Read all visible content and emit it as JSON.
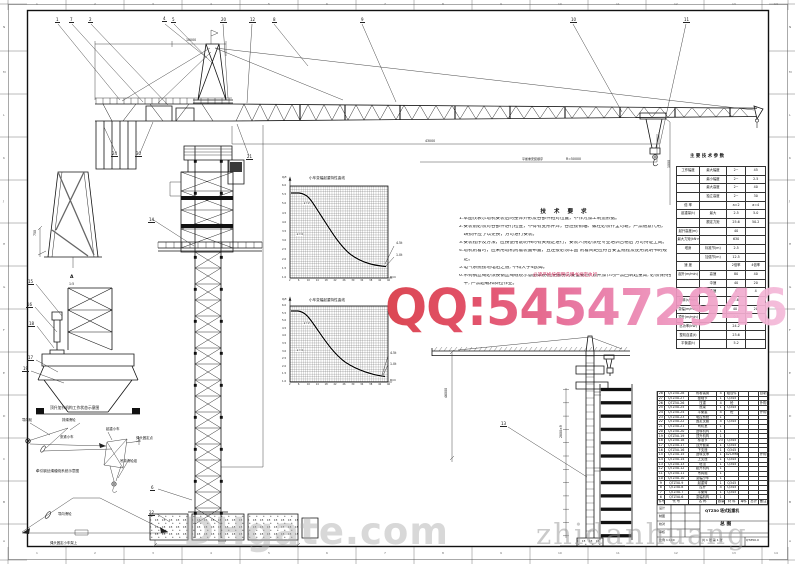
{
  "watermarks": {
    "qq": "QQ:545472946",
    "dhgate": "DHgate.com",
    "seller": "zhidanhuang"
  },
  "notes": {
    "title": "技 术 要 求",
    "lines": [
      "1.本图仅表示塔机安装后的整体外形及各部件相对位置，不作为加工制造依据。",
      "2.安装前必须对各部件进行检查，不得有变形开焊，各连接销轴、螺栓必须齐全可靠，严禁随意代用，",
      "　缺损件应予以更换，方可进行安装。",
      "3.安装程序及方法，应按使用说明书的有关规定进行，安装人员必须经专业培训合格后 方可持证上岗。",
      "4.塔机附着时，应采用塔机附着装置布置，且连接必须牢固 附着间距应符合安全规程及使用说明书的规",
      "　定。",
      "5.电气系统接地电阻之值, 不得大于4欧姆。",
      "6.吊钩钢丝绳必须按钢丝绳缠绕示意图穿绕(红色部分为安全要点, 顶升加节时严禁回转起重臂, 必须保持整机配",
      "　平, 严禁超载和斜拉作业。"
    ],
    "red_fragment": "必须严格按使用说明书规定执行"
  },
  "spec_table": {
    "title": "主 要 技 术 参 数",
    "col_widths": [
      "26%",
      "30%",
      "22%",
      "22%"
    ],
    "rows": [
      [
        "工作幅度",
        "最大幅度",
        "2~",
        "45"
      ],
      [
        "",
        "最小幅度",
        "2~",
        "2.5"
      ],
      [
        "",
        "最大高度",
        "2~",
        "40"
      ],
      [
        "",
        "独立高度",
        "2~",
        "30"
      ],
      [
        "倍  率",
        "",
        "a=2",
        "a=4"
      ],
      [
        "起重量(t)",
        "最大",
        "2.5",
        "5.0"
      ],
      [
        "",
        "额定力矩",
        "25.6",
        "50.2"
      ],
      [
        "起升高度(m)",
        "",
        "40",
        ""
      ],
      [
        "最大力矩(kN·m)",
        "",
        "630",
        ""
      ],
      [
        "塔身",
        "标准节(m)",
        "2.5",
        ""
      ],
      [
        "",
        "加强节(m)",
        "12.5",
        ""
      ],
      [
        "速  度",
        "",
        "2倍率",
        "4倍率"
      ],
      [
        "起升(m/min)",
        "高速",
        "80",
        "40"
      ],
      [
        "　",
        "中速",
        "40",
        "20"
      ],
      [
        "　",
        "低速",
        "8",
        "4"
      ],
      [
        "回转(r/min)",
        "",
        "0.6",
        ""
      ],
      [
        "变幅(m/min)",
        "",
        "40 /",
        "20"
      ],
      [
        "顶升(m/min)",
        "",
        "0.5",
        ""
      ],
      [
        "总功率(kW)",
        "",
        "24.2",
        ""
      ],
      [
        "整机自重(t)",
        "",
        "23.6",
        ""
      ],
      [
        "平衡重(t)",
        "",
        "5.2",
        ""
      ]
    ]
  },
  "bom_table": {
    "col_widths": [
      "6%",
      "22%",
      "26%",
      "7%",
      "13%",
      "9%",
      "9%",
      "8%"
    ],
    "rows": [
      [
        "28",
        "QTZ50.28",
        "附着装置",
        "4",
        "组合件",
        "",
        "",
        "自制"
      ],
      [
        "27",
        "QTZ50.27",
        "基础节",
        "1",
        "Q345",
        "",
        "",
        ""
      ],
      [
        "26",
        "QTZ50.26",
        "压重",
        "4",
        "砼",
        "",
        "",
        "外购"
      ],
      [
        "25",
        "QTZ50.25",
        "底架",
        "1",
        "Q345",
        "",
        "",
        ""
      ],
      [
        "24",
        "QTZ50.24",
        "平衡重",
        "4",
        "砼",
        "",
        "",
        "外购"
      ],
      [
        "23",
        "QTZ50.23",
        "电控系统",
        "1",
        "",
        "",
        "",
        ""
      ],
      [
        "22",
        "QTZ50.22",
        "固定支腿",
        "4",
        "Q345",
        "",
        "",
        ""
      ],
      [
        "21",
        "QTZ50.21",
        "司机室",
        "1",
        "",
        "",
        "",
        ""
      ],
      [
        "20",
        "QTZ50.20",
        "回转机构",
        "1",
        "",
        "",
        "",
        ""
      ],
      [
        "19",
        "QTZ50.19",
        "顶升机构",
        "1",
        "",
        "",
        "",
        ""
      ],
      [
        "18",
        "QTZ50.18",
        "标准节",
        "23",
        "Q345",
        "",
        "",
        ""
      ],
      [
        "17",
        "QTZ50.17",
        "顶升套架",
        "1",
        "Q345",
        "",
        "",
        ""
      ],
      [
        "16",
        "QTZ50.16",
        "下支座",
        "1",
        "Q345",
        "",
        "",
        ""
      ],
      [
        "15",
        "QTZ50.15",
        "回转支承",
        "1",
        "42CrMo",
        "",
        "",
        "外购"
      ],
      [
        "14",
        "QTZ50.14",
        "上支座",
        "1",
        "Q345",
        "",
        "",
        ""
      ],
      [
        "13",
        "QTZ50.13",
        "塔顶",
        "1",
        "Q345",
        "",
        "",
        ""
      ],
      [
        "12",
        "QTZ50.12",
        "起升机构",
        "1",
        "",
        "",
        "",
        ""
      ],
      [
        "11",
        "QTZ50.11",
        "吊钩组",
        "1",
        "",
        "",
        "",
        ""
      ],
      [
        "10",
        "QTZ50.10",
        "变幅小车",
        "1",
        "",
        "",
        "",
        ""
      ],
      [
        "9",
        "QTZ50.9",
        "起重臂",
        "1",
        "Q345",
        "",
        "",
        ""
      ],
      [
        "8",
        "QTZ50.8",
        "拉杆",
        "4",
        "Q345",
        "",
        "",
        ""
      ],
      [
        "7",
        "QTZ50.7",
        "平衡臂",
        "1",
        "Q345",
        "",
        "",
        ""
      ],
      [
        "6",
        "QTZ50.6",
        "变幅机构",
        "1",
        "",
        "",
        "",
        ""
      ]
    ],
    "header": [
      "件号",
      "代  号",
      "名  称",
      "数量",
      "材 料",
      "单件",
      "总计",
      "备注"
    ]
  },
  "callouts": [
    {
      "t": "1",
      "x": 55,
      "y": 18
    },
    {
      "t": "7",
      "x": 69,
      "y": 18
    },
    {
      "t": "2",
      "x": 88,
      "y": 18
    },
    {
      "t": "4",
      "x": 162,
      "y": 17
    },
    {
      "t": "5",
      "x": 171,
      "y": 18
    },
    {
      "t": "20",
      "x": 220,
      "y": 18
    },
    {
      "t": "12",
      "x": 249,
      "y": 18
    },
    {
      "t": "8",
      "x": 272,
      "y": 18
    },
    {
      "t": "9",
      "x": 360,
      "y": 18
    },
    {
      "t": "10",
      "x": 570,
      "y": 18
    },
    {
      "t": "11",
      "x": 683,
      "y": 18
    },
    {
      "t": "24",
      "x": 111,
      "y": 152
    },
    {
      "t": "30",
      "x": 135,
      "y": 152
    },
    {
      "t": "21",
      "x": 246,
      "y": 155
    },
    {
      "t": "14",
      "x": 148,
      "y": 218
    },
    {
      "t": "15",
      "x": 27,
      "y": 280
    },
    {
      "t": "16",
      "x": 26,
      "y": 303
    },
    {
      "t": "18",
      "x": 28,
      "y": 322
    },
    {
      "t": "17",
      "x": 27,
      "y": 356
    },
    {
      "t": "19",
      "x": 22,
      "y": 367
    },
    {
      "t": "6",
      "x": 150,
      "y": 486
    },
    {
      "t": "22",
      "x": 148,
      "y": 511
    },
    {
      "t": "13",
      "x": 500,
      "y": 422
    }
  ],
  "labels": [
    {
      "t": "10000",
      "x": 186,
      "y": 39,
      "s": 3.2
    },
    {
      "t": "43000",
      "x": 425,
      "y": 140,
      "s": 3.2
    },
    {
      "t": "R=50000",
      "x": 566,
      "y": 158,
      "s": 3.2
    },
    {
      "t": "1000",
      "x": 668,
      "y": 168,
      "s": 3.2,
      "r": 1
    },
    {
      "t": "6000",
      "x": 218,
      "y": 540,
      "s": 3.2
    },
    {
      "t": "46000",
      "x": 445,
      "y": 398,
      "s": 3.2,
      "r": 1
    },
    {
      "t": "2800×9",
      "x": 560,
      "y": 438,
      "s": 3.2,
      "r": 1
    },
    {
      "t": "750",
      "x": 34,
      "y": 236,
      "s": 3.2,
      "r": 1
    },
    {
      "t": "A",
      "x": 70,
      "y": 276,
      "s": 4.5,
      "b": 1
    },
    {
      "t": "1:5",
      "x": 69,
      "y": 283,
      "s": 3.2
    },
    {
      "t": "小车变幅起重特性曲线",
      "x": 309,
      "y": 177,
      "s": 3.6
    },
    {
      "t": "Q/t",
      "x": 282,
      "y": 176,
      "s": 3
    },
    {
      "t": "a=2",
      "x": 303,
      "y": 202,
      "s": 3,
      "bg": 1
    },
    {
      "t": "a=4",
      "x": 296,
      "y": 233,
      "s": 3,
      "bg": 1
    },
    {
      "t": "4.5t",
      "x": 396,
      "y": 242,
      "s": 3.2
    },
    {
      "t": "1.0t",
      "x": 396,
      "y": 254,
      "s": 3.2
    },
    {
      "t": "R/m",
      "x": 390,
      "y": 276,
      "s": 3
    },
    {
      "t": "小车变幅起重特性曲线",
      "x": 309,
      "y": 299,
      "s": 3.6
    },
    {
      "t": "Q/t",
      "x": 282,
      "y": 298,
      "s": 3
    },
    {
      "t": "a=2",
      "x": 303,
      "y": 322,
      "s": 3,
      "bg": 1
    },
    {
      "t": "a=4",
      "x": 296,
      "y": 349,
      "s": 3,
      "bg": 1
    },
    {
      "t": "4.5t",
      "x": 390,
      "y": 352,
      "s": 3.2
    },
    {
      "t": "1.0t",
      "x": 390,
      "y": 363,
      "s": 3.2
    },
    {
      "t": "R/m",
      "x": 390,
      "y": 379,
      "s": 3
    },
    {
      "t": "导向轮",
      "x": 22,
      "y": 419,
      "s": 3.4
    },
    {
      "t": "排绳滑轮",
      "x": 62,
      "y": 419,
      "s": 3.4
    },
    {
      "t": "张紧小车",
      "x": 60,
      "y": 436,
      "s": 3.4
    },
    {
      "t": "起重小车",
      "x": 106,
      "y": 428,
      "s": 3.4
    },
    {
      "t": "绳头固定点",
      "x": 136,
      "y": 437,
      "s": 3.4
    },
    {
      "t": "吊钩滑轮组",
      "x": 120,
      "y": 460,
      "s": 3.4
    },
    {
      "t": "牵引钢丝绳缠绕系统示意图",
      "x": 36,
      "y": 470,
      "s": 3.6
    },
    {
      "t": "导向滑轮",
      "x": 58,
      "y": 513,
      "s": 3.4
    },
    {
      "t": "绳头固定小车架上",
      "x": 50,
      "y": 542,
      "s": 3.4
    },
    {
      "t": "顶升加节机构工作状态示意图",
      "x": 50,
      "y": 406,
      "s": 3.8
    },
    {
      "t": "必须严格按使用说明书规定执行",
      "x": 533,
      "y": 274,
      "s": 4.6,
      "c": "#cf3360"
    },
    {
      "t": "平衡重安装顺序",
      "x": 522,
      "y": 158,
      "s": 3
    },
    {
      "t": "设计",
      "x": 659,
      "y": 507,
      "s": 3
    },
    {
      "t": "制图",
      "x": 659,
      "y": 515,
      "s": 3
    },
    {
      "t": "校对",
      "x": 659,
      "y": 523,
      "s": 3
    },
    {
      "t": "审核",
      "x": 659,
      "y": 531,
      "s": 3
    },
    {
      "t": "比例 1:100",
      "x": 659,
      "y": 539,
      "s": 3
    },
    {
      "t": "共 1 张  第 1 张",
      "x": 702,
      "y": 539,
      "s": 3
    },
    {
      "t": "QTZ50.0",
      "x": 746,
      "y": 539,
      "s": 3
    },
    {
      "t": "QTZ50 塔式起重机",
      "x": 705,
      "y": 509,
      "s": 3.8,
      "b": 1
    },
    {
      "t": "总  图",
      "x": 720,
      "y": 523,
      "s": 4.8,
      "b": 1
    },
    {
      "t": "主 要 技 术 参 数",
      "x": 690,
      "y": 155,
      "s": 4.4,
      "b": 1
    }
  ],
  "border": {
    "top": [
      "1",
      "2",
      "3",
      "4",
      "5",
      "6",
      "7",
      "8",
      "9",
      "10",
      "11",
      "12",
      "13",
      "14"
    ],
    "bottom": [
      "1",
      "2",
      "3",
      "4",
      "5",
      "6",
      "7",
      "8",
      "9",
      "10",
      "11",
      "12",
      "13",
      "14"
    ],
    "left": [
      "N",
      "M",
      "L",
      "K",
      "J",
      "H",
      "G",
      "F",
      "E",
      "D",
      "C",
      "B",
      "A"
    ],
    "right": [
      "N",
      "M",
      "L",
      "K",
      "J",
      "H",
      "G",
      "F",
      "E",
      "D",
      "C",
      "B",
      "A"
    ]
  },
  "chart_data": [
    {
      "type": "line",
      "title": "小车变幅起重特性曲线",
      "xlabel": "R/m",
      "ylabel": "Q/t",
      "xlim": [
        2,
        46
      ],
      "ylim": [
        1,
        6
      ],
      "grid": "dense",
      "legend_inline": [
        "a=2",
        "a=4"
      ],
      "yticks": [
        6.0,
        5.5,
        5.0,
        4.5,
        4.0,
        3.5,
        3.0,
        2.5,
        2.0,
        1.5,
        1.0
      ],
      "xticks": [
        2,
        6,
        10,
        14,
        18,
        22,
        26,
        30,
        34,
        38,
        42,
        46
      ],
      "series": [
        {
          "name": "a=2",
          "points": [
            [
              2,
              6.0
            ],
            [
              8,
              6.0
            ],
            [
              12,
              4.8
            ],
            [
              16,
              3.8
            ],
            [
              20,
              3.0
            ],
            [
              26,
              2.2
            ],
            [
              32,
              1.7
            ],
            [
              38,
              1.3
            ],
            [
              46,
              1.0
            ]
          ]
        },
        {
          "name": "a=4",
          "points": [
            [
              2,
              6.0
            ],
            [
              10,
              5.2
            ],
            [
              14,
              4.2
            ],
            [
              20,
              3.1
            ],
            [
              28,
              2.1
            ],
            [
              36,
              1.4
            ],
            [
              46,
              1.0
            ]
          ]
        }
      ],
      "end_labels": [
        "4.5t",
        "1.0t"
      ]
    },
    {
      "type": "line",
      "title": "小车变幅起重特性曲线",
      "xlabel": "R/m",
      "ylabel": "Q/t",
      "xlim": [
        2,
        46
      ],
      "ylim": [
        1,
        6
      ],
      "grid": "dense",
      "legend_inline": [
        "a=2",
        "a=4"
      ],
      "yticks": [
        6.0,
        5.5,
        5.0,
        4.5,
        4.0,
        3.5,
        3.0,
        2.5,
        2.0,
        1.5,
        1.0
      ],
      "xticks": [
        2,
        6,
        10,
        14,
        18,
        22,
        26,
        30,
        34,
        38,
        42,
        46
      ],
      "series": [
        {
          "name": "a=2",
          "points": [
            [
              2,
              6.0
            ],
            [
              8,
              6.0
            ],
            [
              12,
              4.8
            ],
            [
              16,
              3.8
            ],
            [
              20,
              3.0
            ],
            [
              26,
              2.2
            ],
            [
              32,
              1.7
            ],
            [
              38,
              1.3
            ],
            [
              46,
              1.0
            ]
          ]
        },
        {
          "name": "a=4",
          "points": [
            [
              2,
              6.0
            ],
            [
              10,
              5.2
            ],
            [
              14,
              4.2
            ],
            [
              20,
              3.1
            ],
            [
              28,
              2.1
            ],
            [
              36,
              1.4
            ],
            [
              46,
              1.0
            ]
          ]
        }
      ],
      "end_labels": [
        "4.5t",
        "1.0t"
      ]
    }
  ]
}
